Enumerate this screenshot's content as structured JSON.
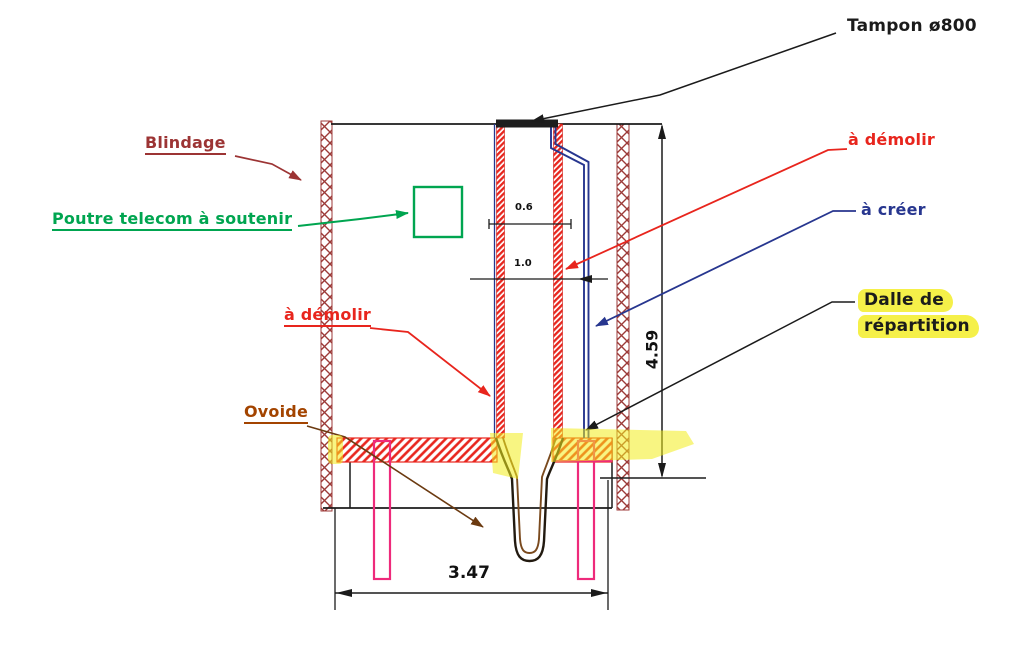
{
  "title": "Coupe technique - fonçage de regard (schéma de principe)",
  "labels": {
    "tampon": "Tampon ø800",
    "blindage": "Blindage",
    "poutre_telecom": "Poutre telecom à soutenir",
    "a_demolir_left": "à démolir",
    "a_demolir_right": "à démolir",
    "a_creer": "à créer",
    "dalle_line1": "Dalle de",
    "dalle_line2": "répartition",
    "ovoide": "Ovoide"
  },
  "dimensions": {
    "total_height_m": "4.59",
    "total_width_m": "3.47",
    "shaft_inner_width_m": "0.6",
    "shaft_outer_width_m": "1.0"
  },
  "colors": {
    "demolish_red": "#e8251d",
    "create_blue": "#27368f",
    "blindage_dark_red": "#9c3a38",
    "telecom_green": "#00a550",
    "ovoide_brown": "#a34400",
    "pile_pink": "#ee2a7b",
    "highlight_yellow": "#f3ec1c",
    "ink_black": "#1b1b1b"
  }
}
